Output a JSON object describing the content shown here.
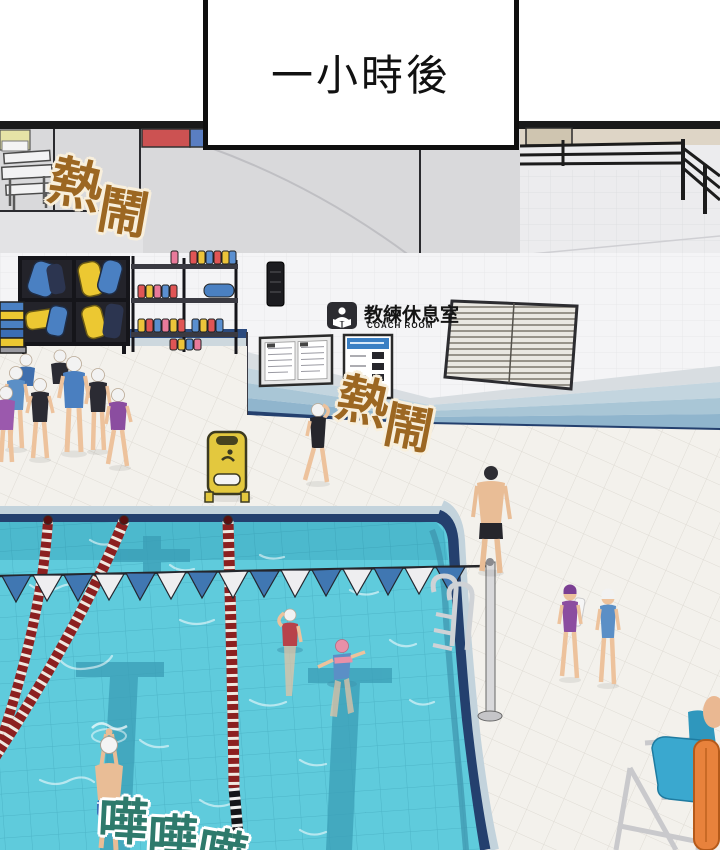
{
  "scene": {
    "caption": "一小時後",
    "sfx_top_left": {
      "chars": [
        "熱",
        "鬧"
      ]
    },
    "sfx_center": {
      "chars": [
        "熱",
        "鬧"
      ]
    },
    "sfx_bottom": {
      "chars": [
        "嘩",
        "嘩",
        "嘩"
      ]
    },
    "coach_room_sign": {
      "title": "教練休息室",
      "subtitle": "COACH ROOM"
    }
  },
  "colors": {
    "sfx_brown": "#9c6722",
    "sfx_teal": "#2e7a6c",
    "water": "#5fcbdc",
    "pool_edge_navy": "#24406e",
    "lane_rope_red": "#8c2020",
    "flag_blue": "#4077b2",
    "wet_sign_yellow": "#e3c83e",
    "chair_seat_blue": "#3aa8cf",
    "rescue_can_orange": "#e8823c",
    "kickboard_blue": "#4a80c2",
    "kickboard_yellow": "#ecc832"
  }
}
